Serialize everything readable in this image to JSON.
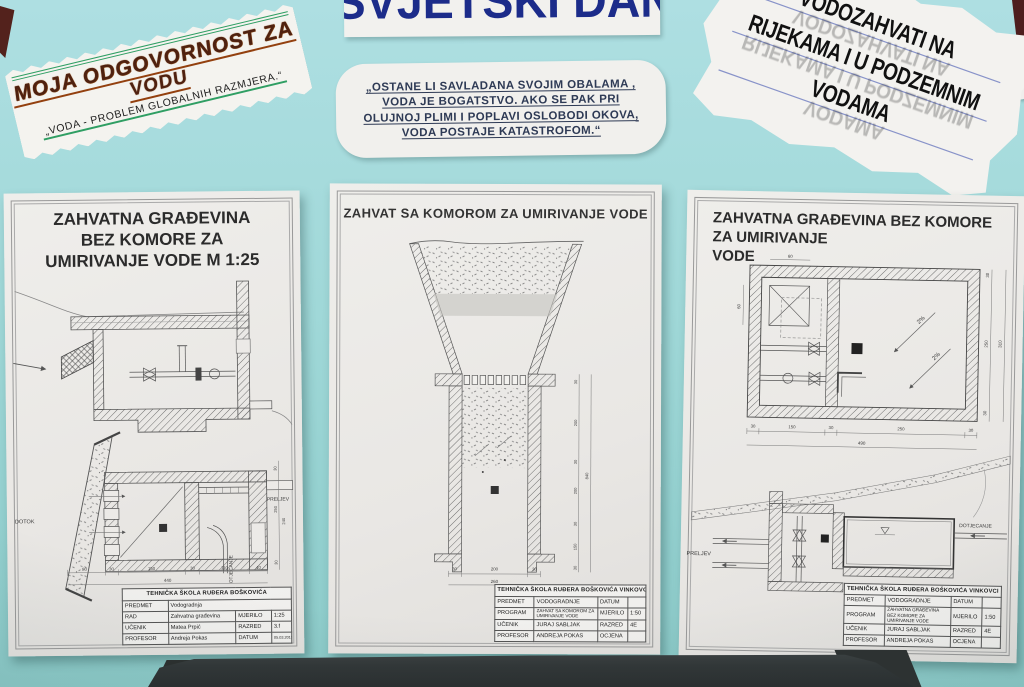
{
  "colors": {
    "board_teal": "#9fd6d6",
    "paper_white": "#edecea",
    "navy_blue": "#1c2c8a",
    "marker_brown": "#4f2110",
    "green_accent": "#2f9e63",
    "ink_black": "#111111",
    "chair_dark": "#34383a"
  },
  "banners": {
    "responsibility": {
      "title_line1": "MOJA ODGOVORNOST ZA",
      "title_line2": "VODU",
      "subtitle": "„VODA - PROBLEM GLOBALNIH RAZMJERA.“"
    },
    "world_water_day": {
      "text": "SVJETSKI DAN VODA"
    },
    "quote": {
      "lines": [
        "„OSTANE LI SAVLADANA SVOJIM OBALAMA ,",
        "VODA JE BOGATSTVO. AKO SE PAK PRI",
        "OLUJNOJ PLIMI I POPLAVI OSLOBODI OKOVA,",
        "VODA POSTAJE KATASTROFOM.“"
      ]
    },
    "water_intakes": {
      "lines": [
        "VODOZAHVATI NA",
        "RIJEKAMA I U PODZEMNIM",
        "VODAMA"
      ]
    }
  },
  "sheets": {
    "left": {
      "title_lines": [
        "ZAHVATNA GRAĐEVINA",
        "BEZ KOMORE ZA",
        "UMIRIVANJE VODE M 1:25"
      ],
      "labels": {
        "dotok": "DOTOK",
        "preljev": "PRELJEV",
        "otjecanje": "OTJECANJE"
      },
      "dims": {
        "bottom": [
          "80",
          "30",
          "150",
          "30",
          "110",
          "40"
        ],
        "bottom_total": "440",
        "right": [
          "30",
          "250",
          "240",
          "30"
        ]
      },
      "titleblock": {
        "school": "TEHNIČKA ŠKOLA RUĐERA BOŠKOVIĆA",
        "rows": [
          {
            "label": "PREDMET",
            "value": "Vodogradnja",
            "label2": "",
            "value2": ""
          },
          {
            "label": "RAD",
            "value": "Zahvatna građevina",
            "label2": "MJERILO",
            "value2": "1:25"
          },
          {
            "label": "UČENIK",
            "value": "Matea Prpić",
            "label2": "RAZRED",
            "value2": "3.f"
          },
          {
            "label": "PROFESOR",
            "value": "Andreja Pokas",
            "label2": "DATUM",
            "value2": "05.03.2015."
          }
        ]
      }
    },
    "center": {
      "title": "ZAHVAT SA KOMOROM ZA UMIRIVANJE VODE",
      "dims": {
        "right": [
          "30",
          "200",
          "30",
          "200",
          "30",
          "150",
          "30"
        ],
        "right_total": "840",
        "bottom": [
          "30",
          "200",
          "30"
        ],
        "bottom_total": "260"
      },
      "titleblock": {
        "school": "TEHNIČKA ŠKOLA RUĐERA BOŠKOVIĆA VINKOVCI",
        "rows": [
          {
            "label": "PREDMET",
            "value": "VODOGRADNJE",
            "label2": "DATUM",
            "value2": ""
          },
          {
            "label": "PROGRAM",
            "value": "ZAHVAT SA KOMOROM ZA UMIRIVANJE VODE",
            "label2": "MJERILO",
            "value2": "1:50"
          },
          {
            "label": "UČENIK",
            "value": "JURAJ SABLJAK",
            "label2": "RAZRED",
            "value2": "4E"
          },
          {
            "label": "PROFESOR",
            "value": "ANDREJA POKAS",
            "label2": "OCJENA",
            "value2": ""
          }
        ]
      }
    },
    "right": {
      "title_lines": [
        "ZAHVATNA GRAĐEVINA BEZ KOMORE ZA UMIRIVANJE",
        "VODE"
      ],
      "labels": {
        "preljev": "PRELJEV",
        "dotjecanje": "DOTJECANJE",
        "slope": "2%"
      },
      "dims": {
        "plan_bottom": [
          "30",
          "150",
          "30",
          "250",
          "30"
        ],
        "plan_bottom_total": "490",
        "plan_right": [
          "30",
          "250",
          "30"
        ],
        "plan_right_total": "310",
        "plan_top": "60",
        "plan_left": "60"
      },
      "titleblock": {
        "school": "TEHNIČKA ŠKOLA RUĐERA BOŠKOVIĆA VINKOVCI",
        "rows": [
          {
            "label": "PREDMET",
            "value": "VODOGRADNJE",
            "label2": "DATUM",
            "value2": ""
          },
          {
            "label": "PROGRAM",
            "value": "ZAHVATNA GRAĐEVINA BEZ KOMORE ZA UMIRIVANJE VODE",
            "label2": "MJERILO",
            "value2": "1:50"
          },
          {
            "label": "UČENIK",
            "value": "JURAJ SABLJAK",
            "label2": "RAZRED",
            "value2": "4E"
          },
          {
            "label": "PROFESOR",
            "value": "ANDREJA POKAS",
            "label2": "OCJENA",
            "value2": ""
          }
        ]
      }
    }
  }
}
